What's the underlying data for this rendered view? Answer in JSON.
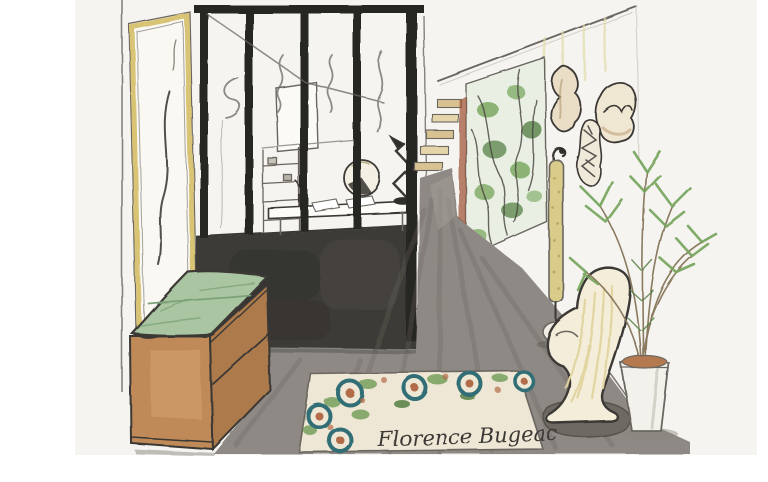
{
  "artwork": {
    "signature": "Florence Bugeac"
  },
  "scene": {
    "objects": [
      "gold-framed mirror",
      "black steel glass partition",
      "home office with desk and zigzag lamp",
      "dark half wall",
      "floating staircase",
      "vertical garden panel",
      "organic wall art pieces",
      "gold column floor lamp",
      "wooden sideboard with green cushion",
      "patterned area rug",
      "sculptural cream chair",
      "potted palm",
      "artist signature"
    ]
  },
  "palette": {
    "paper": "#f6f4f0",
    "ink": "#3a3835",
    "pencil": "#6b6660",
    "wall_dark": "#3d3b37",
    "floor": "#8e8984",
    "floor_streak": "#6c6862",
    "wood": "#c08a58",
    "wood_shade": "#ad7a4b",
    "cushion": "#a9c5a1",
    "cushion_line": "#7da279",
    "gold": "#d5bd66",
    "lamp_gold": "#d9cb8a",
    "plant": "#74a35a",
    "plant_dark": "#4c7a3c",
    "rug_cream": "#efe7d5",
    "rug_teal": "#326e76",
    "rug_rust": "#b26c49",
    "rug_green": "#6f9c55",
    "chair_cream": "#f3edda",
    "chair_streak": "#e3d49f",
    "stair_tan": "#d8c291",
    "panel_wash": "#e9f0e3",
    "pot_white": "#f3f1ec",
    "soil": "#b5794f"
  }
}
